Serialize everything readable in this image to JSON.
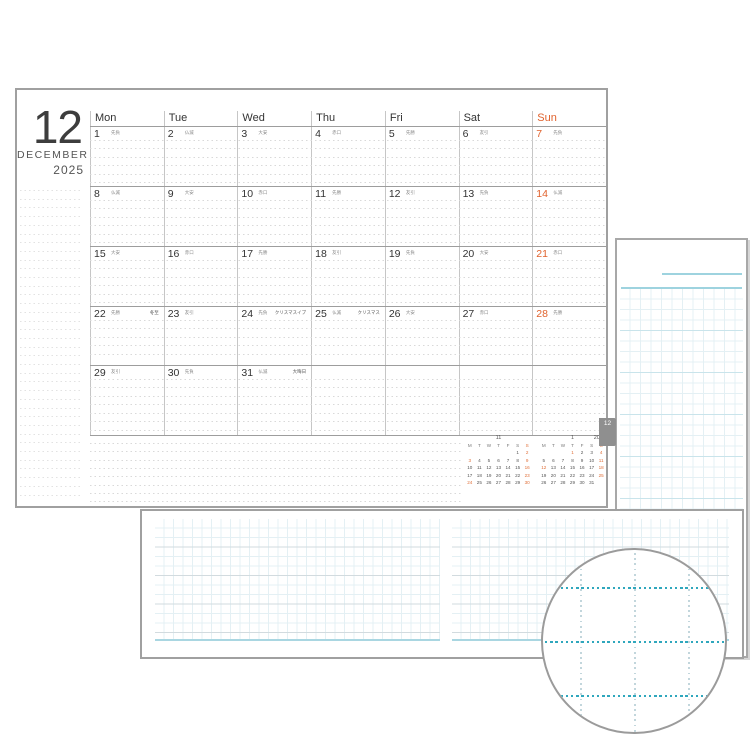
{
  "title": {
    "month_number": "12",
    "month_name": "DECEMBER",
    "year": "2025"
  },
  "tab_label": "12",
  "day_headers": [
    "Mon",
    "Tue",
    "Wed",
    "Thu",
    "Fri",
    "Sat",
    "Sun"
  ],
  "weeks": [
    [
      {
        "date": "1",
        "rokuyo": "先負"
      },
      {
        "date": "2",
        "rokuyo": "仏滅"
      },
      {
        "date": "3",
        "rokuyo": "大安"
      },
      {
        "date": "4",
        "rokuyo": "赤口"
      },
      {
        "date": "5",
        "rokuyo": "先勝"
      },
      {
        "date": "6",
        "rokuyo": "友引"
      },
      {
        "date": "7",
        "rokuyo": "先負",
        "sunday": true
      }
    ],
    [
      {
        "date": "8",
        "rokuyo": "仏滅"
      },
      {
        "date": "9",
        "rokuyo": "大安"
      },
      {
        "date": "10",
        "rokuyo": "赤口"
      },
      {
        "date": "11",
        "rokuyo": "先勝"
      },
      {
        "date": "12",
        "rokuyo": "友引"
      },
      {
        "date": "13",
        "rokuyo": "先負"
      },
      {
        "date": "14",
        "rokuyo": "仏滅",
        "sunday": true
      }
    ],
    [
      {
        "date": "15",
        "rokuyo": "大安"
      },
      {
        "date": "16",
        "rokuyo": "赤口"
      },
      {
        "date": "17",
        "rokuyo": "先勝"
      },
      {
        "date": "18",
        "rokuyo": "友引"
      },
      {
        "date": "19",
        "rokuyo": "先負"
      },
      {
        "date": "20",
        "rokuyo": "大安"
      },
      {
        "date": "21",
        "rokuyo": "赤口",
        "sunday": true
      }
    ],
    [
      {
        "date": "22",
        "rokuyo": "先勝",
        "note": "冬至"
      },
      {
        "date": "23",
        "rokuyo": "友引"
      },
      {
        "date": "24",
        "rokuyo": "先負",
        "note": "クリスマスイブ"
      },
      {
        "date": "25",
        "rokuyo": "仏滅",
        "note": "クリスマス"
      },
      {
        "date": "26",
        "rokuyo": "大安"
      },
      {
        "date": "27",
        "rokuyo": "赤口"
      },
      {
        "date": "28",
        "rokuyo": "先勝",
        "sunday": true
      }
    ],
    [
      {
        "date": "29",
        "rokuyo": "友引"
      },
      {
        "date": "30",
        "rokuyo": "先負"
      },
      {
        "date": "31",
        "rokuyo": "仏滅",
        "note": "大晦日"
      },
      {},
      {},
      {},
      {}
    ]
  ],
  "mini_calendars": [
    {
      "label": "11",
      "year_label": "",
      "day_headers": [
        "M",
        "T",
        "W",
        "T",
        "F",
        "S",
        "S"
      ],
      "rows": [
        [
          "",
          "",
          "",
          "",
          "",
          "1",
          "2"
        ],
        [
          "3",
          "4",
          "5",
          "6",
          "7",
          "8",
          "9"
        ],
        [
          "10",
          "11",
          "12",
          "13",
          "14",
          "15",
          "16"
        ],
        [
          "17",
          "18",
          "19",
          "20",
          "21",
          "22",
          "23"
        ],
        [
          "24",
          "25",
          "26",
          "27",
          "28",
          "29",
          "30"
        ]
      ],
      "highlighted": [
        "2",
        "3",
        "9",
        "16",
        "23",
        "24",
        "30"
      ]
    },
    {
      "label": "1",
      "year_label": "2026",
      "day_headers": [
        "M",
        "T",
        "W",
        "T",
        "F",
        "S",
        "S"
      ],
      "rows": [
        [
          "",
          "",
          "",
          "1",
          "2",
          "3",
          "4"
        ],
        [
          "5",
          "6",
          "7",
          "8",
          "9",
          "10",
          "11"
        ],
        [
          "12",
          "13",
          "14",
          "15",
          "16",
          "17",
          "18"
        ],
        [
          "19",
          "20",
          "21",
          "22",
          "23",
          "24",
          "25"
        ],
        [
          "26",
          "27",
          "28",
          "29",
          "30",
          "31",
          ""
        ]
      ],
      "highlighted": [
        "1",
        "4",
        "11",
        "12",
        "18",
        "25"
      ]
    }
  ],
  "colors": {
    "sunday_orange": "#e0622d",
    "mini_orange": "#e0703a",
    "grid_blue": "#e4f0f4",
    "teal_line": "#9ed3df",
    "magnifier_dot_teal": "#2fa7bd",
    "magnifier_dot_light": "#c2d6dc",
    "tab_gray": "#8f8f8f"
  }
}
